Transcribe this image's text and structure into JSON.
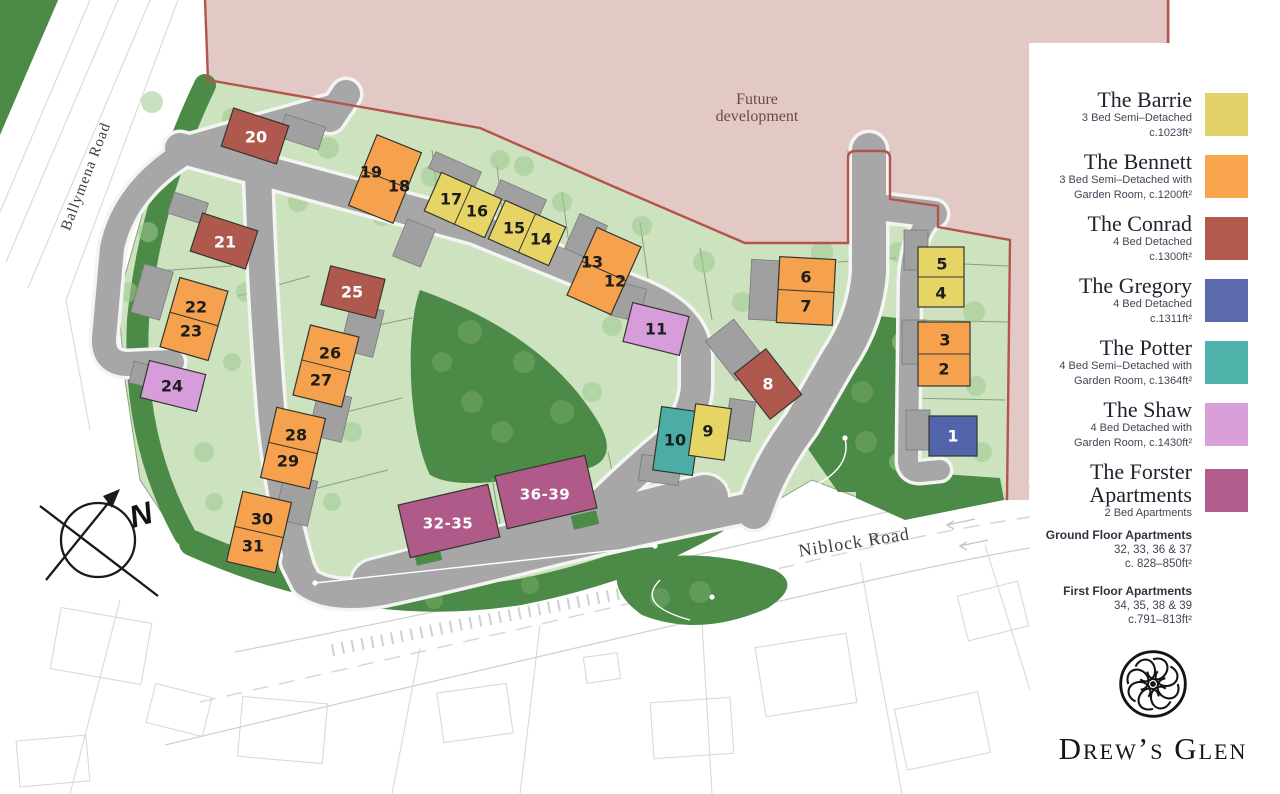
{
  "map": {
    "future_line1": "Future",
    "future_line2": "development",
    "roads": {
      "ballymena": "Ballymena Road",
      "niblock": "Niblock Road"
    },
    "compass_label": "N",
    "house_colors": {
      "barrie": "#e6d565",
      "bennett": "#f6a14d",
      "conrad": "#af594e",
      "gregory": "#5265aa",
      "potter": "#4bada5",
      "shaw": "#d79ddb",
      "forster": "#b05a89"
    },
    "area_colors": {
      "future_development_fill": "#e2c9c6",
      "boundary_red": "#b4544c",
      "plot_green": "#cde3bf",
      "open_space_green": "#4c8a47",
      "road_grey": "#a7a7a7"
    },
    "buildings": [
      {
        "type": "conrad",
        "x": 255,
        "y": 136,
        "w": 58,
        "h": 40,
        "rot": 18,
        "units": [
          {
            "n": "20",
            "x": 256,
            "y": 137,
            "light": true
          }
        ]
      },
      {
        "type": "bennett",
        "x": 385,
        "y": 179,
        "w": 48,
        "h": 76,
        "rot": 22,
        "units": [
          {
            "n": "19",
            "x": 371,
            "y": 172
          },
          {
            "n": "18",
            "x": 399,
            "y": 186
          }
        ]
      },
      {
        "type": "barrie",
        "x": 463,
        "y": 205,
        "w": 66,
        "h": 42,
        "rot": 24,
        "units": [
          {
            "n": "17",
            "x": 451,
            "y": 199
          },
          {
            "n": "16",
            "x": 477,
            "y": 211
          }
        ]
      },
      {
        "type": "barrie",
        "x": 527,
        "y": 233,
        "w": 66,
        "h": 42,
        "rot": 24,
        "units": [
          {
            "n": "15",
            "x": 514,
            "y": 228
          },
          {
            "n": "14",
            "x": 541,
            "y": 239
          }
        ]
      },
      {
        "type": "bennett",
        "x": 604,
        "y": 271,
        "w": 48,
        "h": 74,
        "rot": 24,
        "units": [
          {
            "n": "13",
            "x": 592,
            "y": 262
          },
          {
            "n": "12",
            "x": 615,
            "y": 281
          }
        ]
      },
      {
        "type": "conrad",
        "x": 224,
        "y": 241,
        "w": 58,
        "h": 40,
        "rot": 18,
        "units": [
          {
            "n": "21",
            "x": 225,
            "y": 242,
            "light": true
          }
        ]
      },
      {
        "type": "bennett",
        "x": 194,
        "y": 319,
        "w": 50,
        "h": 72,
        "rot": 16,
        "units": [
          {
            "n": "22",
            "x": 196,
            "y": 307
          },
          {
            "n": "23",
            "x": 191,
            "y": 331
          }
        ]
      },
      {
        "type": "conrad",
        "x": 353,
        "y": 292,
        "w": 56,
        "h": 40,
        "rot": 14,
        "units": [
          {
            "n": "25",
            "x": 352,
            "y": 292,
            "light": true
          }
        ]
      },
      {
        "type": "bennett",
        "x": 326,
        "y": 366,
        "w": 50,
        "h": 72,
        "rot": 14,
        "units": [
          {
            "n": "26",
            "x": 330,
            "y": 353
          },
          {
            "n": "27",
            "x": 321,
            "y": 380
          }
        ]
      },
      {
        "type": "shaw",
        "x": 173,
        "y": 386,
        "w": 58,
        "h": 38,
        "rot": 14,
        "units": [
          {
            "n": "24",
            "x": 172,
            "y": 386
          }
        ]
      },
      {
        "type": "bennett",
        "x": 293,
        "y": 448,
        "w": 50,
        "h": 72,
        "rot": 13,
        "units": [
          {
            "n": "28",
            "x": 296,
            "y": 435
          },
          {
            "n": "29",
            "x": 288,
            "y": 461
          }
        ]
      },
      {
        "type": "bennett",
        "x": 259,
        "y": 532,
        "w": 50,
        "h": 72,
        "rot": 13,
        "units": [
          {
            "n": "30",
            "x": 262,
            "y": 519
          },
          {
            "n": "31",
            "x": 253,
            "y": 546
          }
        ]
      },
      {
        "type": "shaw",
        "x": 656,
        "y": 329,
        "w": 58,
        "h": 40,
        "rot": 14,
        "units": [
          {
            "n": "11",
            "x": 656,
            "y": 329
          }
        ]
      },
      {
        "type": "bennett",
        "x": 806,
        "y": 291,
        "w": 56,
        "h": 66,
        "rot": 3,
        "units": [
          {
            "n": "6",
            "x": 806,
            "y": 277
          },
          {
            "n": "7",
            "x": 806,
            "y": 306
          }
        ]
      },
      {
        "type": "conrad",
        "x": 768,
        "y": 384,
        "w": 40,
        "h": 58,
        "rot": -38,
        "units": [
          {
            "n": "8",
            "x": 768,
            "y": 384,
            "light": true
          }
        ]
      },
      {
        "type": "potter",
        "x": 677,
        "y": 441,
        "w": 40,
        "h": 64,
        "rot": 8,
        "units": [
          {
            "n": "10",
            "x": 675,
            "y": 440
          }
        ]
      },
      {
        "type": "barrie",
        "x": 710,
        "y": 432,
        "w": 36,
        "h": 52,
        "rot": 8,
        "units": [
          {
            "n": "9",
            "x": 708,
            "y": 431
          }
        ]
      },
      {
        "type": "barrie",
        "x": 941,
        "y": 277,
        "w": 46,
        "h": 60,
        "rot": 0,
        "units": [
          {
            "n": "5",
            "x": 942,
            "y": 264
          },
          {
            "n": "4",
            "x": 941,
            "y": 293
          }
        ]
      },
      {
        "type": "bennett",
        "x": 944,
        "y": 354,
        "w": 52,
        "h": 64,
        "rot": 0,
        "units": [
          {
            "n": "3",
            "x": 945,
            "y": 340
          },
          {
            "n": "2",
            "x": 944,
            "y": 369
          }
        ]
      },
      {
        "type": "gregory",
        "x": 953,
        "y": 436,
        "w": 48,
        "h": 40,
        "rot": 0,
        "units": [
          {
            "n": "1",
            "x": 953,
            "y": 436,
            "light": true
          }
        ]
      },
      {
        "type": "forster",
        "x": 449,
        "y": 521,
        "w": 92,
        "h": 54,
        "rot": -13,
        "units": [
          {
            "n": "32-35",
            "x": 448,
            "y": 523,
            "light": true
          }
        ]
      },
      {
        "type": "forster",
        "x": 546,
        "y": 492,
        "w": 92,
        "h": 54,
        "rot": -13,
        "units": [
          {
            "n": "36-39",
            "x": 545,
            "y": 494,
            "light": true
          }
        ]
      }
    ]
  },
  "legend": {
    "items": [
      {
        "name": "The Barrie",
        "desc_lines": [
          "3 Bed Semi–Detached",
          "c.1023ft²"
        ],
        "color": "#e3d269"
      },
      {
        "name": "The Bennett",
        "desc_lines": [
          "3 Bed Semi–Detached with",
          "Garden Room, c.1200ft²"
        ],
        "color": "#f8a54e"
      },
      {
        "name": "The Conrad",
        "desc_lines": [
          "4 Bed Detached",
          "c.1300ft²"
        ],
        "color": "#b2594e"
      },
      {
        "name": "The Gregory",
        "desc_lines": [
          "4 Bed Detached",
          "c.1311ft²"
        ],
        "color": "#5b6aac"
      },
      {
        "name": "The Potter",
        "desc_lines": [
          "4 Bed Semi–Detached with",
          "Garden Room, c.1364ft²"
        ],
        "color": "#4fb3ab"
      },
      {
        "name": "The Shaw",
        "desc_lines": [
          "4 Bed Detached with",
          "Garden Room, c.1430ft²"
        ],
        "color": "#d89fd8"
      },
      {
        "name": "The Forster Apartments",
        "name_lines": [
          "The Forster",
          "Apartments"
        ],
        "desc_lines": [
          "2 Bed Apartments"
        ],
        "color": "#b15d8c"
      }
    ],
    "apartment_notes": [
      {
        "title": "Ground Floor Apartments",
        "line1": "32, 33, 36 & 37",
        "line2": "c. 828–850ft²"
      },
      {
        "title": "First Floor Apartments",
        "line1": "34, 35, 38 & 39",
        "line2": "c.791–813ft²"
      }
    ],
    "brand": "Drew’s Glen"
  }
}
